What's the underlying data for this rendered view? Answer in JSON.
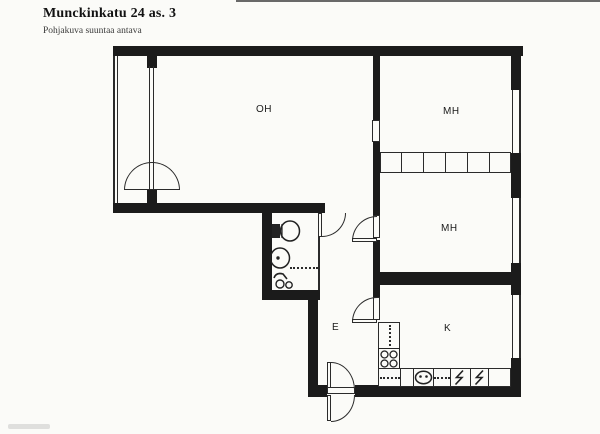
{
  "header": {
    "title": "Munckinkatu 24 as. 3",
    "subtitle": "Pohjakuva suuntaa antava"
  },
  "rooms": [
    {
      "name": "living-room",
      "label": "OH"
    },
    {
      "name": "bedroom-1",
      "label": "MH"
    },
    {
      "name": "bedroom-2",
      "label": "MH"
    },
    {
      "name": "kitchen",
      "label": "K"
    },
    {
      "name": "hallway",
      "label": "E"
    }
  ],
  "fixtures": [
    "toilet-icon",
    "washbasin-icon",
    "shower-icon",
    "stove-icon",
    "kitchen-sink-icon",
    "refrigerator-icon",
    "wardrobe-row",
    "balcony-double-door",
    "entrance-door"
  ],
  "colors": {
    "wall": "#1b1b1b",
    "paper": "#fbfbf8",
    "line": "#2b2b2b"
  }
}
